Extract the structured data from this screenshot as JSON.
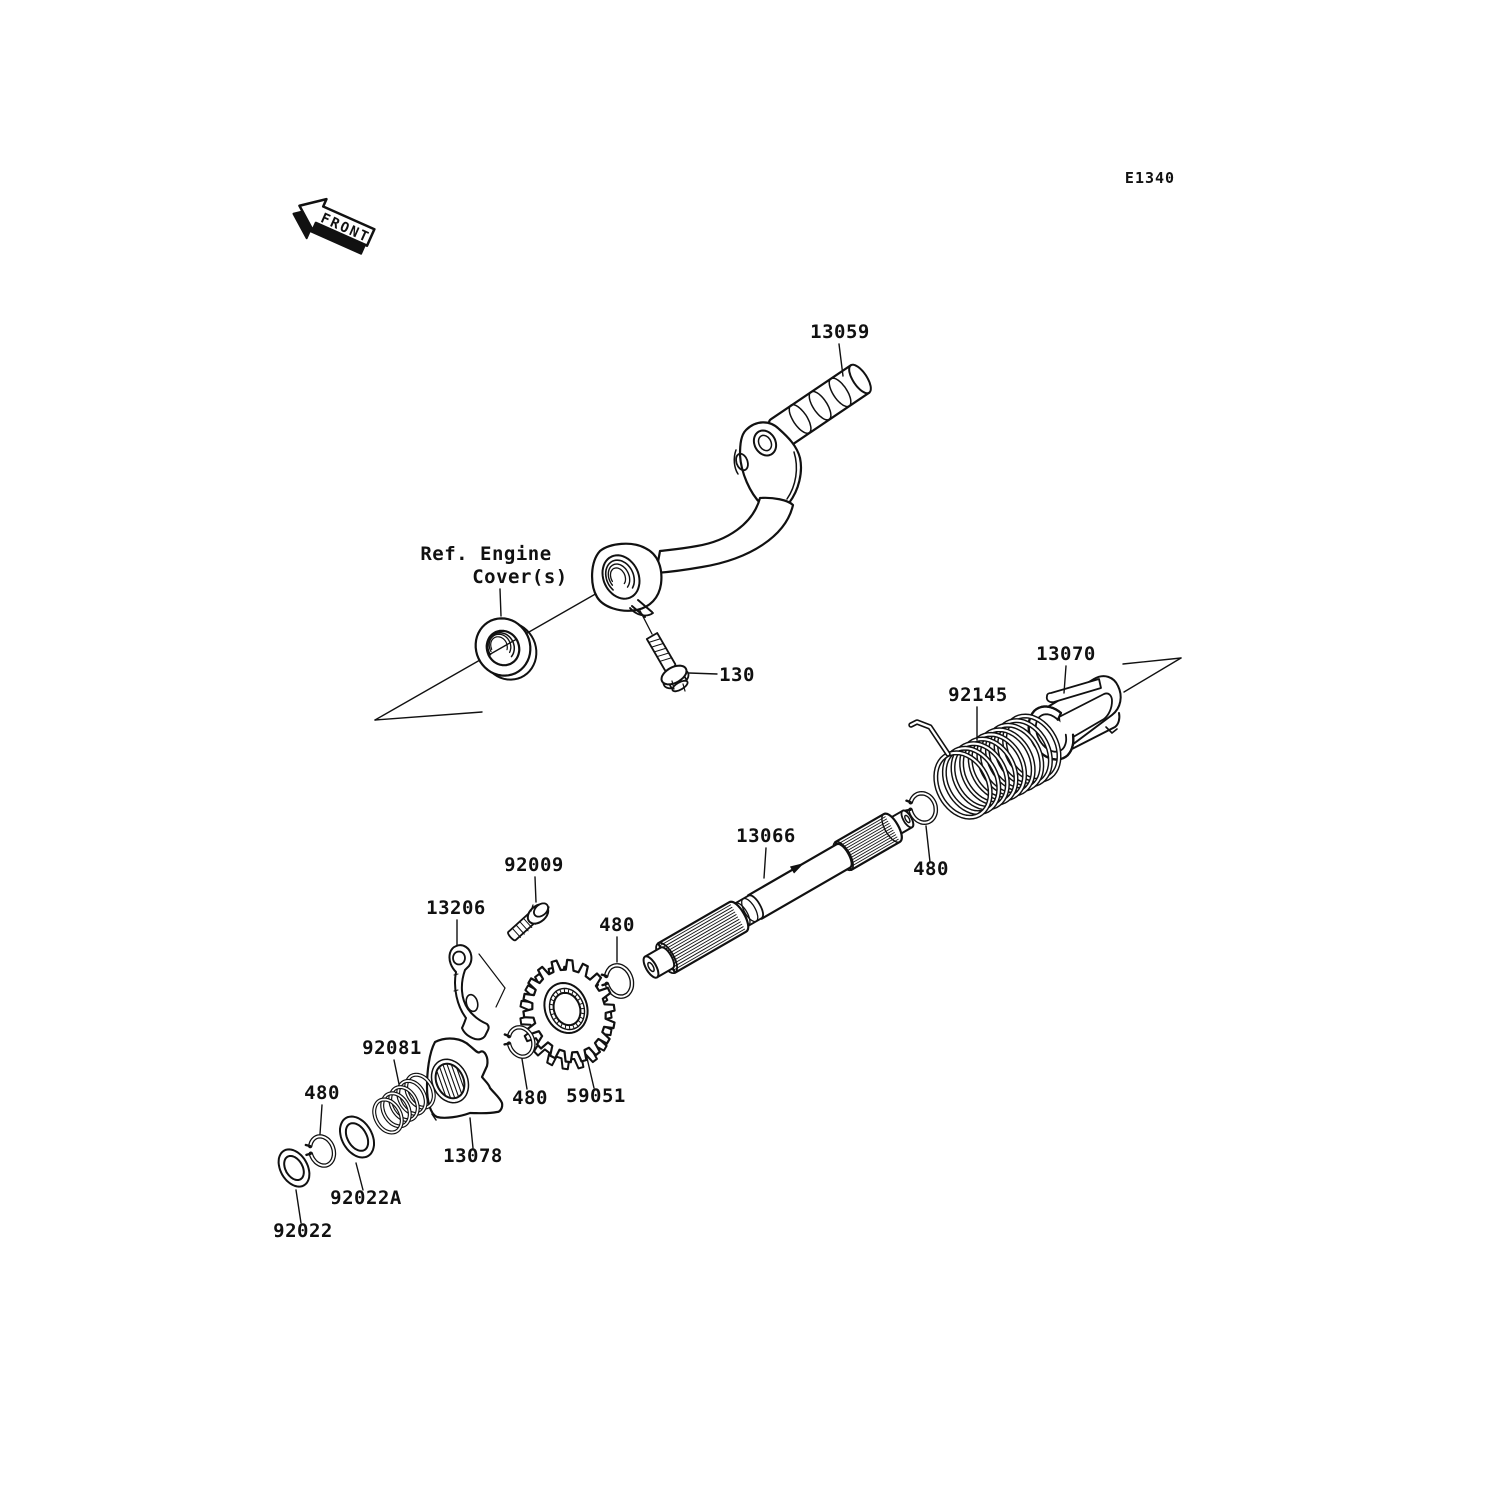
{
  "diagram": {
    "page_code": "E1340",
    "front_arrow_label": "FRONT",
    "reference_note": {
      "line1": "Ref. Engine",
      "line2": "Cover(s)"
    },
    "callouts": [
      {
        "label": "13059"
      },
      {
        "label": "130"
      },
      {
        "label": "13070"
      },
      {
        "label": "92145"
      },
      {
        "label": "480"
      },
      {
        "label": "13066"
      },
      {
        "label": "92009"
      },
      {
        "label": "13206"
      },
      {
        "label": "480"
      },
      {
        "label": "59051"
      },
      {
        "label": "480"
      },
      {
        "label": "92081"
      },
      {
        "label": "480"
      },
      {
        "label": "13078"
      },
      {
        "label": "92022A"
      },
      {
        "label": "92022"
      }
    ],
    "colors": {
      "ink": "#111111",
      "paper": "#ffffff"
    }
  }
}
